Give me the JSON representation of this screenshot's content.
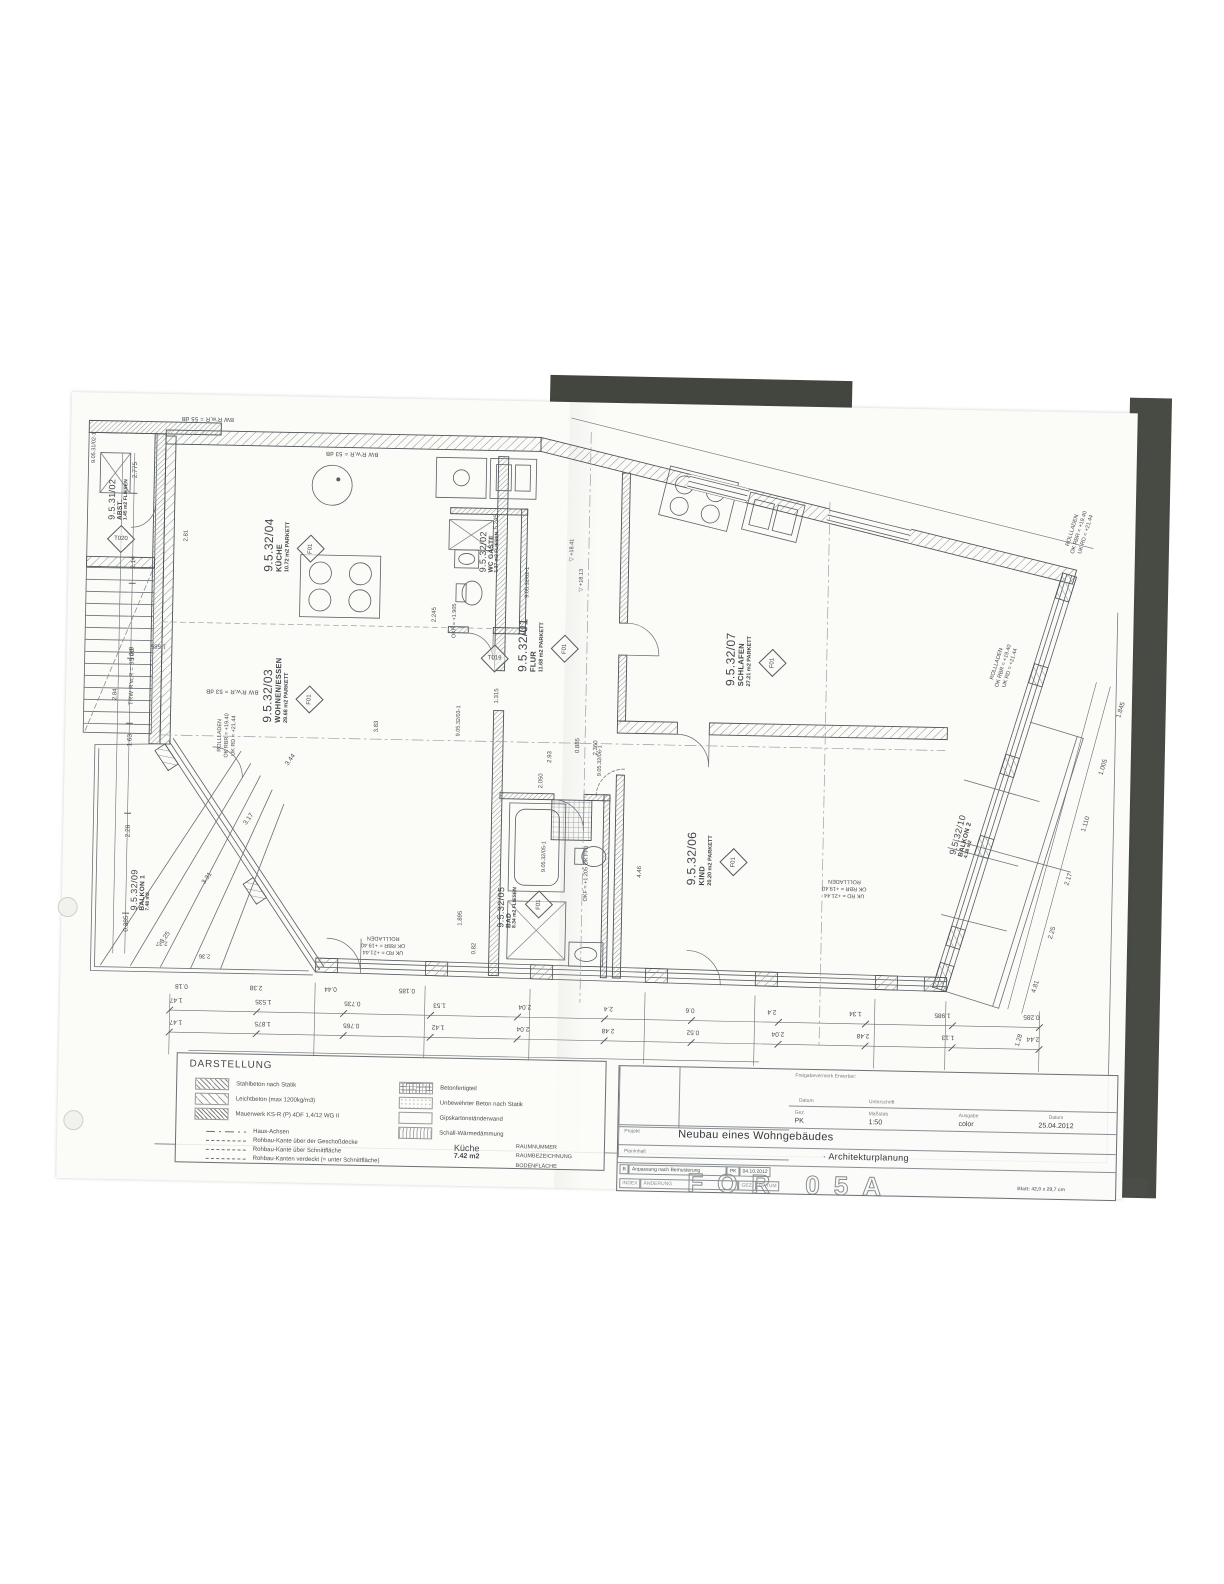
{
  "title_block": {
    "freigabevermerk": "Freigabevermerk Erwerber:",
    "datum_label": "Datum",
    "unterschrift_label": "Unterschrift",
    "gez_label": "Gez.",
    "gez_value": "PK",
    "massstab_label": "Maßstab",
    "massstab_value": "1:50",
    "ausgabe_label": "Ausgabe",
    "ausgabe_value": "color",
    "datum2_label": "Datum",
    "datum_value": "25.04.2012",
    "projekt_label": "Projekt",
    "projekt_value": "Neubau eines Wohngebäudes",
    "planinhalt_label": "Planinhalt",
    "planinhalt_value": "· Architekturplanung",
    "blatt_note": "Blatt: 42,0 x 29,7 cm",
    "stamp_partial": "FOR 05A",
    "revision": {
      "index": "B",
      "text": "Anpassung nach Bemusterung",
      "gez": "PK",
      "datum": "04.10.2012",
      "header_index": "INDEX",
      "header_text": "ÄNDERUNG",
      "header_gez": "GEZ.",
      "header_datum": "DATUM"
    }
  },
  "legend": {
    "title": "DARSTELLUNG",
    "materials": [
      {
        "label": "Stahlbeton nach Statik"
      },
      {
        "label": "Leichtbeton (max 1200kg/m3)"
      },
      {
        "label": "Mauerwerk KS-R (P) 4DF  1,4/12  WG II"
      },
      {
        "label": "Betonfertigteil"
      },
      {
        "label": "Unbewehrter Beton nach Statik"
      },
      {
        "label": "Gipskartonständerwand"
      },
      {
        "label": "Schall-Wärmedämmung"
      }
    ],
    "lines": [
      "Haus-Achsen",
      "Rohbau-Kante über der Geschoßdecke",
      "Rohbau-Kante über Schnittfläche",
      "Rohbau-Kanten verdeckt (= unter Schnittfläche)"
    ],
    "sample": {
      "name": "Küche",
      "area": "7.42 m2",
      "labels": [
        "RAUMNUMMER",
        "RAUMBEZEICHNUNG",
        "BODENFLÄCHE"
      ]
    }
  },
  "rooms": [
    {
      "id": "9.5.32/01",
      "name": "FLUR",
      "area": "11.68 m2",
      "floor": "PARKETT",
      "tag": "F01"
    },
    {
      "id": "9.5.32/02",
      "name": "WC GÄSTE",
      "area": "1.37 m2",
      "floor": "FLIESEN",
      "tag": "F01"
    },
    {
      "id": "9.5.32/03",
      "name": "WOHNEN/ESSEN",
      "area": "29.68 m2",
      "floor": "PARKETT",
      "tag": "F01"
    },
    {
      "id": "9.5.32/04",
      "name": "KÜCHE",
      "area": "10.72 m2",
      "floor": "PARKETT",
      "tag": "F01"
    },
    {
      "id": "9.5.32/05",
      "name": "BAD",
      "area": "8.34 m2",
      "floor": "FLIESEN",
      "tag": "F01"
    },
    {
      "id": "9.5.32/06",
      "name": "KIND",
      "area": "20.20 m2",
      "floor": "PARKETT",
      "tag": "F01"
    },
    {
      "id": "9.5.32/07",
      "name": "SCHLAFEN",
      "area": "27.21 m2",
      "floor": "PARKETT",
      "tag": "F01"
    },
    {
      "id": "9.5.32/09",
      "name": "BALKON 1",
      "area": "7.48 m2",
      "floor": "",
      "tag": ""
    },
    {
      "id": "9.5.32/10",
      "name": "BALKON 2",
      "area": "4.38 m2",
      "floor": "",
      "tag": ""
    },
    {
      "id": "9.5.31/02",
      "name": "ABST.",
      "area": "1.45 m2",
      "floor": "FLIESEN",
      "tag": "T02"
    }
  ],
  "annotations": {
    "rollladen": [
      "ROLLLADEN",
      "OK RBR = +19.40",
      "UK RD = +21.44"
    ],
    "sound_top": "BW  R'w,R = 53 dB",
    "sound_left": "TRW  R'w,R = 55 dB",
    "sound_topleft": "BW  R'w,R = 55 dB",
    "door_tags": [
      "9.05.32/02-1",
      "9.05.32/03-1",
      "9.05.32/05-1",
      "9.05.32/06-1",
      "9.05.31/02-1"
    ],
    "diamond_tags": [
      "T019",
      "T020"
    ],
    "levels": [
      "▽ +18.41",
      "▽ +18.13",
      "OKF = +1.905",
      "OKF = +1.205  OK FFB"
    ]
  },
  "dimensions": {
    "bottom_chain_upper": [
      "0.285",
      "1.985",
      "1.34",
      "2.4",
      "0.6",
      "2.4",
      "2.04",
      "1.53",
      "0.735",
      "1.535",
      "1.47"
    ],
    "bottom_chain_lower": [
      "2.44",
      "1.13",
      "2.48",
      "2.04",
      "0.52",
      "2.48",
      "2.04",
      "1.42",
      "0.765",
      "1.875",
      "1.47"
    ],
    "bottom_chain_small": [
      "0.185",
      "0.44",
      "2.38",
      "0.18"
    ],
    "left_chain": [
      "0.385",
      "2.28",
      "1.63",
      "0.9",
      "2.14",
      "2.775"
    ],
    "right_chain": [
      "1.28",
      "4.81",
      "2.25",
      "2.17",
      "1.110",
      "1.005",
      "1.845",
      "2.765"
    ],
    "balcony_dims": [
      "3.25",
      "3.31",
      "3.17",
      "3.44"
    ],
    "inline": [
      "5.245",
      "2.81",
      "2.84",
      "1.585",
      "2.93",
      "2.050",
      "0.885",
      "2.360",
      "4.46",
      "3.83",
      "2.245",
      "1.315",
      "1.895",
      "0.82",
      "2.37",
      "2.36"
    ]
  }
}
